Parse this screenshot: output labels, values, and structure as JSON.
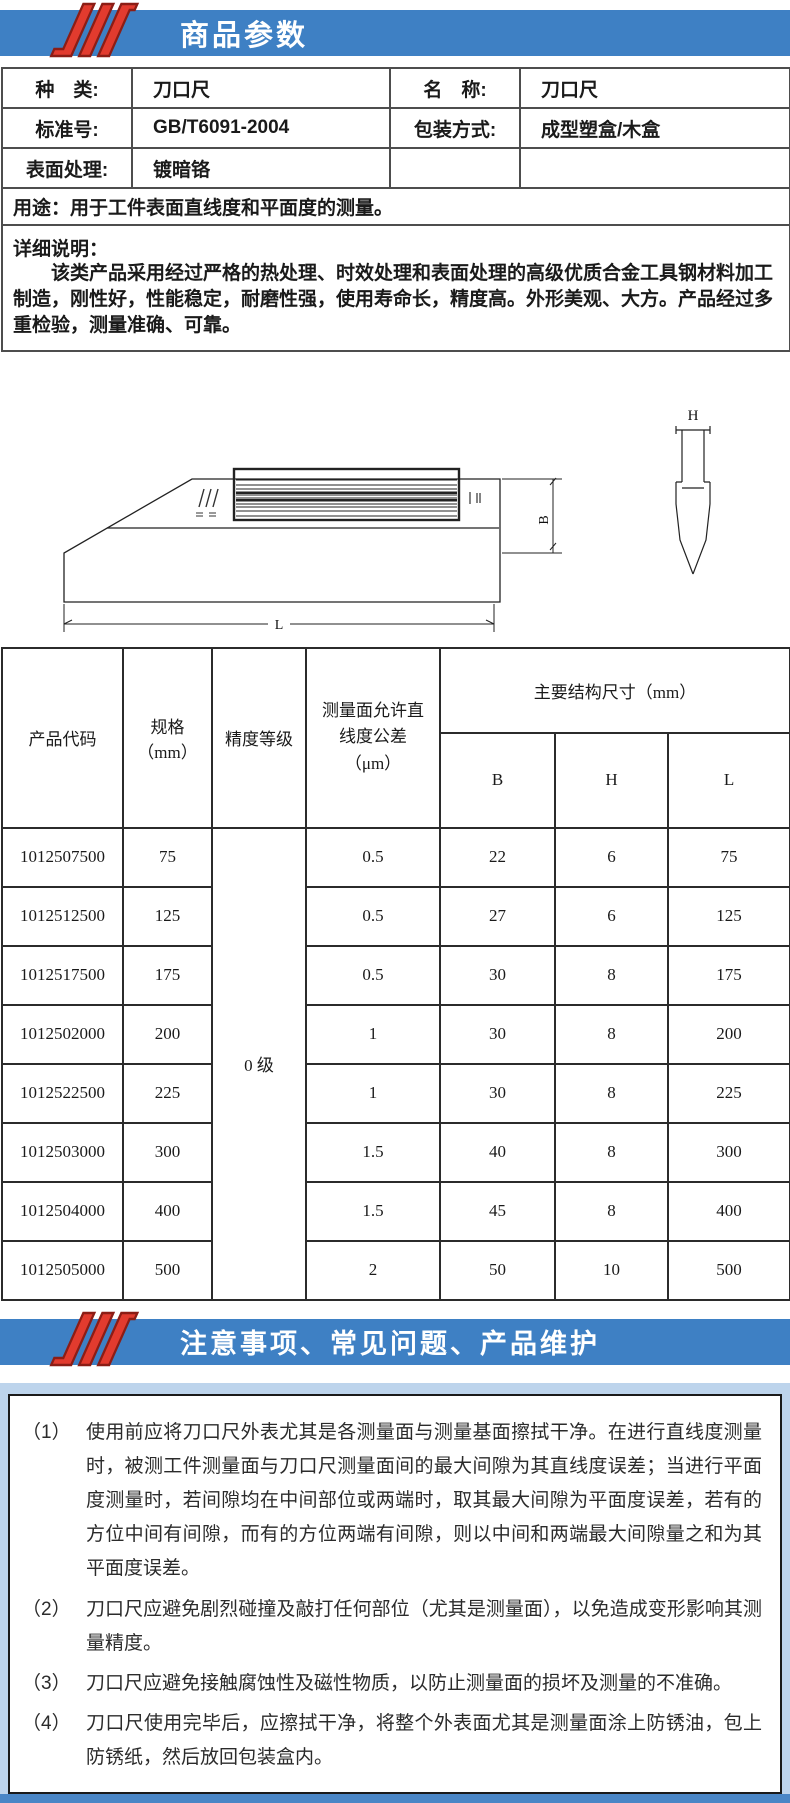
{
  "colors": {
    "bar_blue": "#3e80c4",
    "logo_red": "#e23b2e",
    "logo_dark_red": "#8c1d15",
    "notes_bg_blue": "#bdd4ec",
    "strip_blue": "#4a86c6"
  },
  "header1": {
    "title": "商品参数"
  },
  "params": {
    "rows": [
      {
        "l1": "种　类:",
        "v1": "刀口尺",
        "l2": "名　称:",
        "v2": "刀口尺"
      },
      {
        "l1": "标准号:",
        "v1": "GB/T6091-2004",
        "l2": "包装方式:",
        "v2": "成型塑盒/木盒"
      },
      {
        "l1": "表面处理:",
        "v1": "镀暗铬",
        "l2": "",
        "v2": ""
      }
    ],
    "usage_label": "用途：",
    "usage_text": "用于工件表面直线度和平面度的测量。",
    "detail_label": "详细说明：",
    "detail_text": "该类产品采用经过严格的热处理、时效处理和表面处理的高级优质合金工具钢材料加工制造，刚性好，性能稳定，耐磨性强，使用寿命长，精度高。外形美观、大方。产品经过多重检验，测量准确、可靠。"
  },
  "drawing": {
    "dim_b": "B",
    "dim_h": "H",
    "dim_l": "L"
  },
  "spec": {
    "col_code": "产品代码",
    "col_size_l1": "规格",
    "col_size_l2": "（mm）",
    "col_grade": "精度等级",
    "col_tol_l1": "测量面允许直",
    "col_tol_l2": "线度公差",
    "col_tol_l3": "（μm）",
    "group_header": "主要结构尺寸（mm）",
    "col_b": "B",
    "col_h": "H",
    "col_l": "L",
    "grade_value": "0 级",
    "rows": [
      {
        "code": "1012507500",
        "size": "75",
        "tol": "0.5",
        "b": "22",
        "h": "6",
        "l": "75"
      },
      {
        "code": "1012512500",
        "size": "125",
        "tol": "0.5",
        "b": "27",
        "h": "6",
        "l": "125"
      },
      {
        "code": "1012517500",
        "size": "175",
        "tol": "0.5",
        "b": "30",
        "h": "8",
        "l": "175"
      },
      {
        "code": "1012502000",
        "size": "200",
        "tol": "1",
        "b": "30",
        "h": "8",
        "l": "200"
      },
      {
        "code": "1012522500",
        "size": "225",
        "tol": "1",
        "b": "30",
        "h": "8",
        "l": "225"
      },
      {
        "code": "1012503000",
        "size": "300",
        "tol": "1.5",
        "b": "40",
        "h": "8",
        "l": "300"
      },
      {
        "code": "1012504000",
        "size": "400",
        "tol": "1.5",
        "b": "45",
        "h": "8",
        "l": "400"
      },
      {
        "code": "1012505000",
        "size": "500",
        "tol": "2",
        "b": "50",
        "h": "10",
        "l": "500"
      }
    ]
  },
  "header2": {
    "title": "注意事项、常见问题、产品维护"
  },
  "notes": [
    {
      "num": "（1）",
      "text": "使用前应将刀口尺外表尤其是各测量面与测量基面擦拭干净。在进行直线度测量时，被测工件测量面与刀口尺测量面间的最大间隙为其直线度误差；当进行平面度测量时，若间隙均在中间部位或两端时，取其最大间隙为平面度误差，若有的方位中间有间隙，而有的方位两端有间隙，则以中间和两端最大间隙量之和为其平面度误差。"
    },
    {
      "num": "（2）",
      "text": "刀口尺应避免剧烈碰撞及敲打任何部位（尤其是测量面），以免造成变形影响其测量精度。"
    },
    {
      "num": "（3）",
      "text": "刀口尺应避免接触腐蚀性及磁性物质，以防止测量面的损坏及测量的不准确。"
    },
    {
      "num": "（4）",
      "text": "刀口尺使用完毕后，应擦拭干净，将整个外表面尤其是测量面涂上防锈油，包上防锈纸，然后放回包装盒内。"
    }
  ]
}
